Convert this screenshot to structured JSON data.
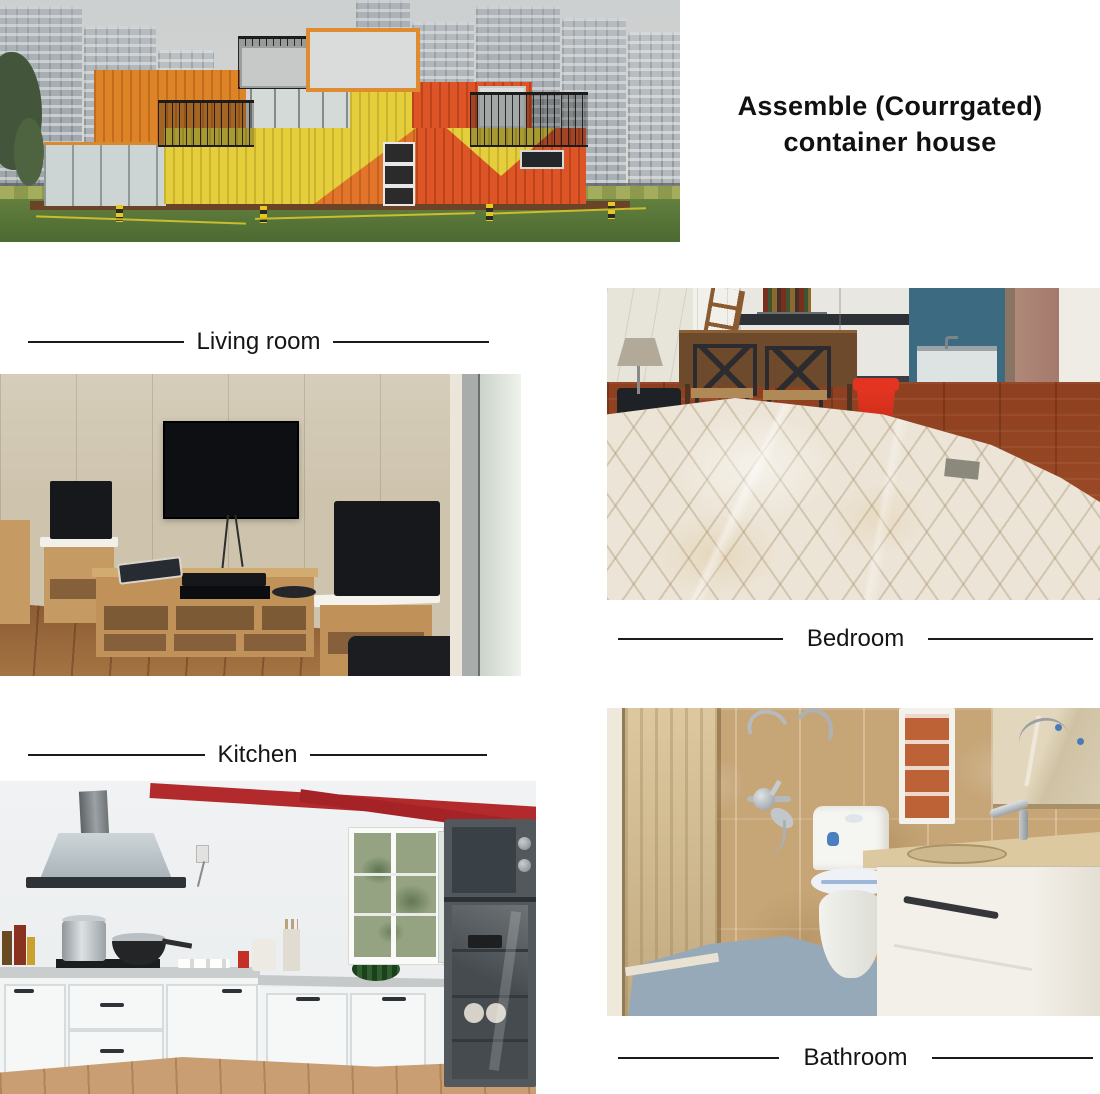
{
  "title": {
    "line1": "Assemble (Courrgated)",
    "line2": "container house"
  },
  "sections": {
    "living_room": {
      "label": "Living room",
      "photo_subject": "living room with wall-mounted TV, wooden TV stand and black speakers"
    },
    "bedroom": {
      "label": "Bedroom",
      "photo_subject": "bedroom with plastic-wrapped quilted mattress, dining table and red stool"
    },
    "kitchen": {
      "label": "Kitchen",
      "photo_subject": "kitchen with white cabinets, range hood, window and tall dark cabinet"
    },
    "bathroom": {
      "label": "Bathroom",
      "photo_subject": "bathroom with shower fittings, toilet, vanity and mirror"
    }
  },
  "hero": {
    "photo_subject": "orange and yellow shipping container house on lawn with high-rise buildings behind"
  },
  "colors": {
    "container_orange": "#dd8428",
    "container_yellow": "#e4ce3c",
    "container_red": "#dd5527",
    "beam_red": "#b22a2c",
    "text": "#111111",
    "background": "#ffffff"
  }
}
